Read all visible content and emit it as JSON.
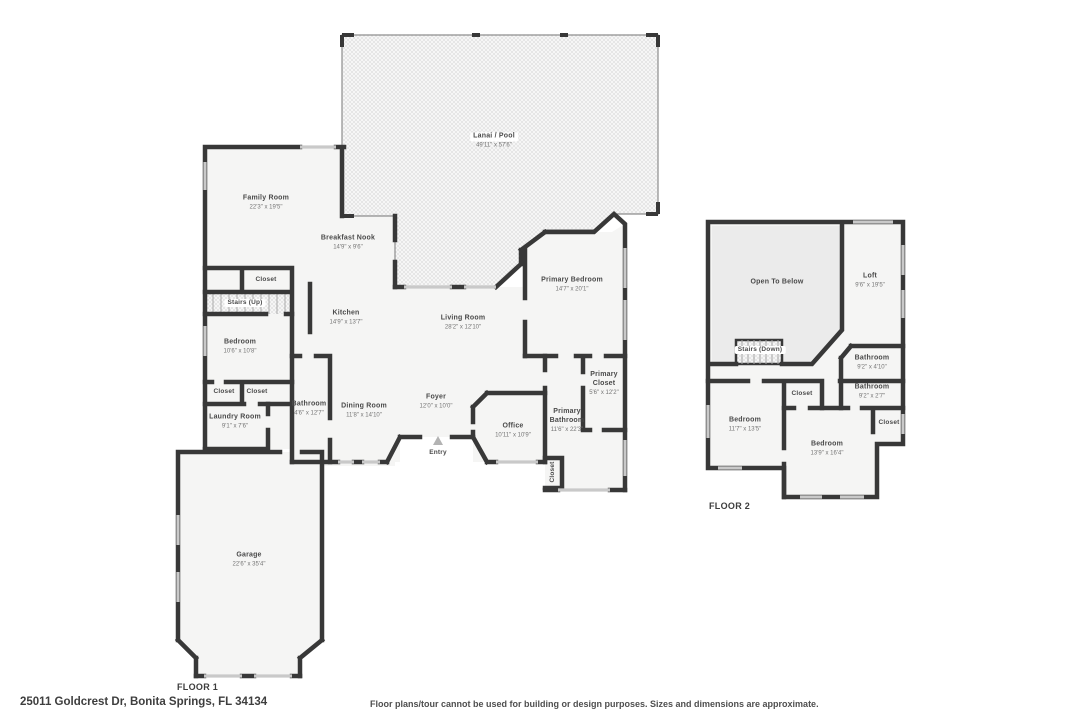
{
  "page": {
    "address": "25011 Goldcrest Dr, Bonita Springs, FL 34134",
    "disclaimer": "Floor plans/tour cannot be used for building or design purposes. Sizes and dimensions are approximate."
  },
  "floor1": {
    "label": "FLOOR 1",
    "rooms": [
      {
        "name": "Lanai / Pool",
        "dims": "49'11\" x 57'6\""
      },
      {
        "name": "Family Room",
        "dims": "22'3\" x 19'5\""
      },
      {
        "name": "Breakfast Nook",
        "dims": "14'9\" x 9'6\""
      },
      {
        "name": "Kitchen",
        "dims": "14'9\" x 13'7\""
      },
      {
        "name": "Living Room",
        "dims": "28'2\" x 12'10\""
      },
      {
        "name": "Primary Bedroom",
        "dims": "14'7\" x 20'1\""
      },
      {
        "name": "Primary Closet",
        "dims": "5'6\" x 12'2\""
      },
      {
        "name": "Primary Bathroom",
        "dims": "11'6\" x 22'3\""
      },
      {
        "name": "Office",
        "dims": "10'11\" x 10'9\""
      },
      {
        "name": "Foyer",
        "dims": "12'0\" x 10'0\""
      },
      {
        "name": "Dining Room",
        "dims": "11'8\" x 14'10\""
      },
      {
        "name": "Bedroom",
        "dims": "10'6\" x 10'8\""
      },
      {
        "name": "Laundry Room",
        "dims": "9'1\" x 7'6\""
      },
      {
        "name": "Bathroom",
        "dims": "4'6\" x 12'7\""
      },
      {
        "name": "Garage",
        "dims": "22'6\" x 35'4\""
      },
      {
        "name": "Stairs (Up)"
      },
      {
        "name": "Entry"
      },
      {
        "name": "Closet"
      },
      {
        "name": "Closet"
      },
      {
        "name": "Closet"
      },
      {
        "name": "Closet"
      }
    ]
  },
  "floor2": {
    "label": "FLOOR 2",
    "rooms": [
      {
        "name": "Open To Below"
      },
      {
        "name": "Loft",
        "dims": "9'6\" x 19'5\""
      },
      {
        "name": "Stairs (Down)"
      },
      {
        "name": "Bathroom",
        "dims": "9'2\" x 4'10\""
      },
      {
        "name": "Bathroom",
        "dims": "9'2\" x 2'7\""
      },
      {
        "name": "Bedroom",
        "dims": "11'7\" x 13'5\""
      },
      {
        "name": "Bedroom",
        "dims": "13'9\" x 16'4\""
      },
      {
        "name": "Closet"
      },
      {
        "name": "Closet"
      }
    ]
  }
}
